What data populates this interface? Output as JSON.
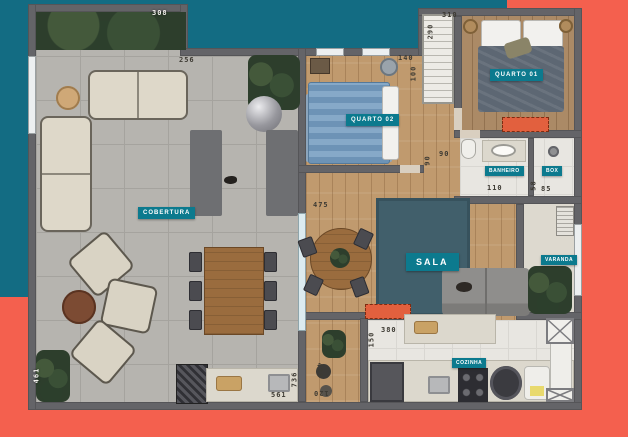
{
  "colors": {
    "background_teal": "#136c83",
    "background_coral": "#f4604e",
    "badge_teal": "#0c7a8e",
    "wall_gray": "#646468",
    "highlight_orange": "#e2603e"
  },
  "rooms": {
    "cobertura": "COBERTURA",
    "quarto02": "QUARTO 02",
    "quarto01": "QUARTO 01",
    "banheiro": "BANHEIRO",
    "box": "BOX",
    "sala": "SALA",
    "varanda": "VARANDA",
    "cozinha": "COZINHA"
  },
  "dimensions": {
    "d308": "308",
    "d256": "256",
    "d310": "310",
    "d290": "290",
    "d140": "140",
    "d100": "100",
    "d90h": "90",
    "d90v": "90",
    "d110": "110",
    "d85": "85",
    "d58": "58",
    "d475": "475",
    "d425": "425",
    "d120": "120",
    "d380": "380",
    "d150": "150",
    "d561": "561",
    "d736": "736",
    "d461": "461"
  }
}
